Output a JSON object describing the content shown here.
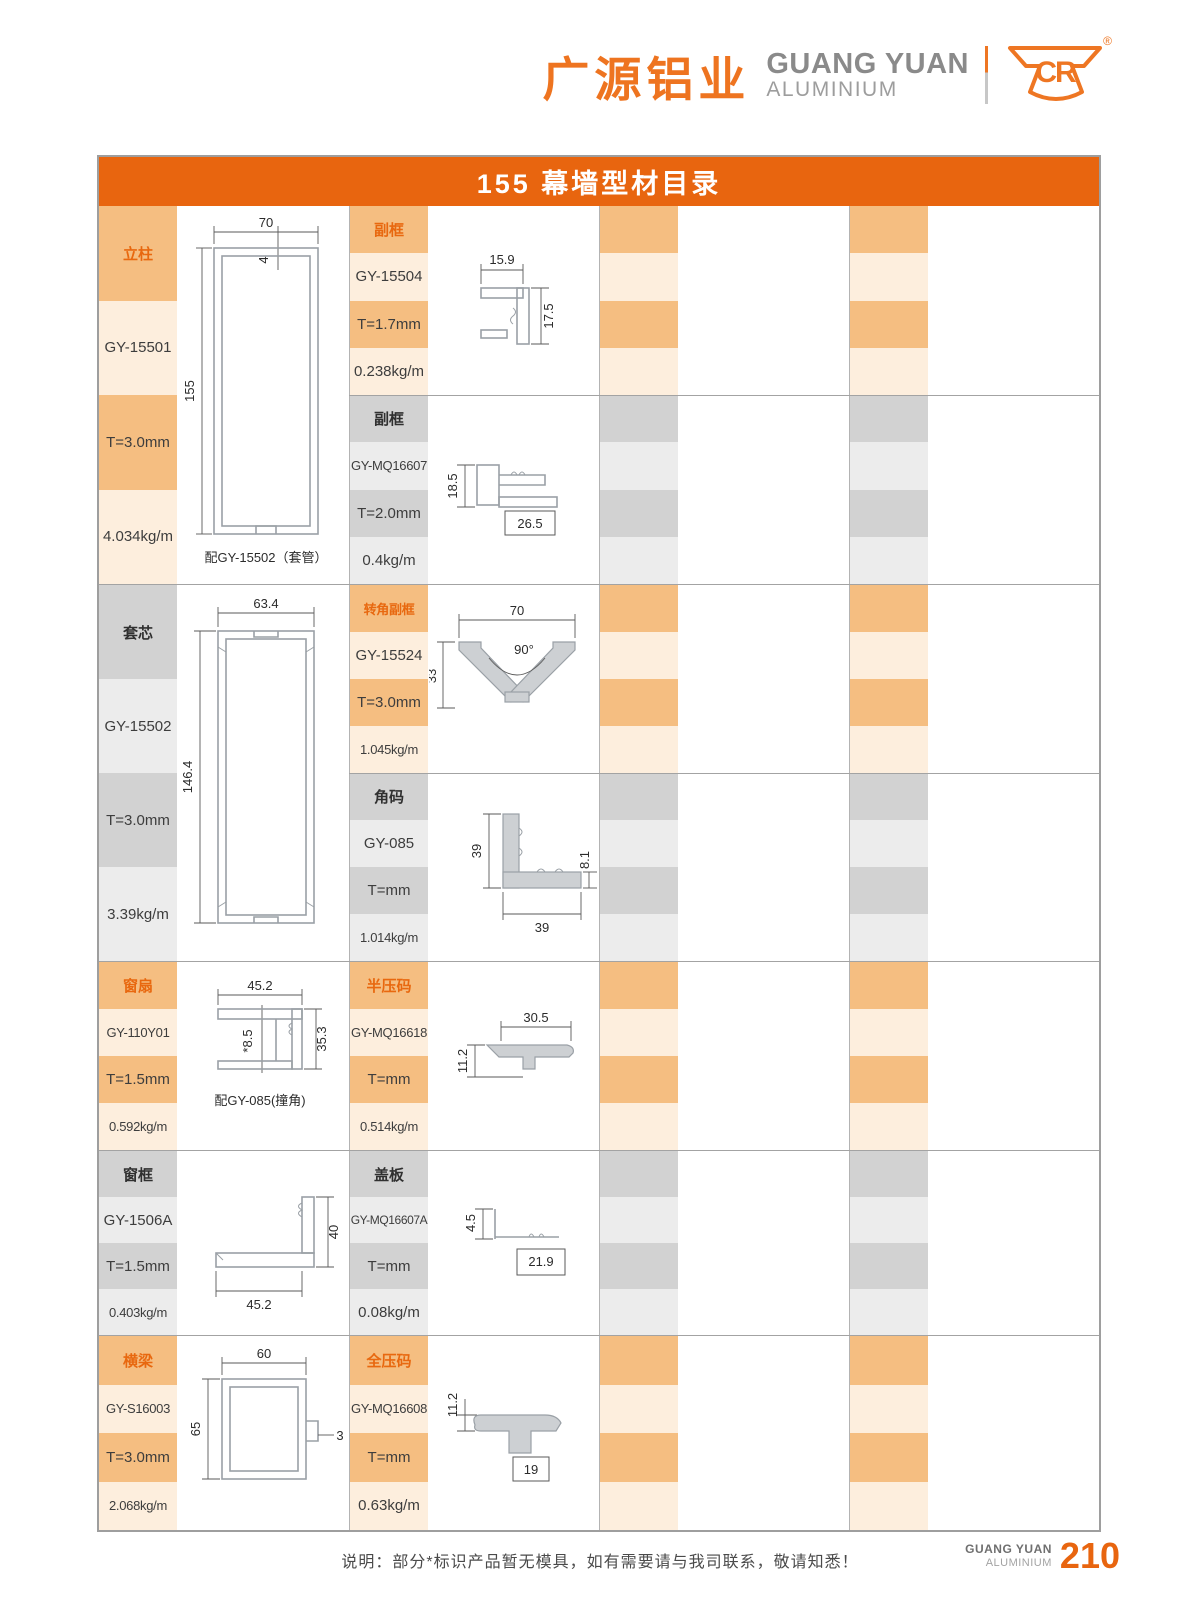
{
  "header": {
    "brand_cn": "广源铝业",
    "brand_en": "GUANG YUAN",
    "brand_sub": "ALUMINIUM",
    "logo_text": "CR",
    "reg_mark": "®"
  },
  "title_bar": {
    "text": "155 幕墙型材目录"
  },
  "bands": [
    {
      "left": {
        "name": "立柱",
        "code": "GY-15501",
        "thickness": "T=3.0mm",
        "weight": "4.034kg/m",
        "caption": "配GY-15502（套管）",
        "dims": {
          "width": "70",
          "wall": "4",
          "height": "155"
        }
      },
      "mid_top": {
        "name": "副框",
        "code": "GY-15504",
        "thickness": "T=1.7mm",
        "weight": "0.238kg/m",
        "dims": {
          "width": "15.9",
          "height": "17.5"
        }
      },
      "mid_bottom": {
        "name": "副框",
        "code": "GY-MQ16607",
        "thickness": "T=2.0mm",
        "weight": "0.4kg/m",
        "dims": {
          "height": "18.5",
          "width": "26.5"
        }
      }
    },
    {
      "left": {
        "name": "套芯",
        "code": "GY-15502",
        "thickness": "T=3.0mm",
        "weight": "3.39kg/m",
        "dims": {
          "width": "63.4",
          "height": "146.4"
        }
      },
      "mid_top": {
        "name": "转角副框",
        "code": "GY-15524",
        "thickness": "T=3.0mm",
        "weight": "1.045kg/m",
        "dims": {
          "width": "70",
          "angle": "90°",
          "height": "33"
        }
      },
      "mid_bottom": {
        "name": "角码",
        "code": "GY-085",
        "thickness": "T=mm",
        "weight": "1.014kg/m",
        "dims": {
          "height": "39",
          "width": "39",
          "depth": "8.1"
        }
      }
    },
    {
      "left": {
        "name": "窗扇",
        "code": "GY-110Y01",
        "thickness": "T=1.5mm",
        "weight": "0.592kg/m",
        "caption": "配GY-085(撞角)",
        "dims": {
          "width": "45.2",
          "inner": "*8.5",
          "height": "35.3"
        }
      },
      "mid": {
        "name": "半压码",
        "code": "GY-MQ16618",
        "thickness": "T=mm",
        "weight": "0.514kg/m",
        "dims": {
          "width": "30.5",
          "height": "11.2"
        }
      }
    },
    {
      "left": {
        "name": "窗框",
        "code": "GY-1506A",
        "thickness": "T=1.5mm",
        "weight": "0.403kg/m",
        "dims": {
          "height": "40",
          "width": "45.2"
        }
      },
      "mid": {
        "name": "盖板",
        "code": "GY-MQ16607A",
        "thickness": "T=mm",
        "weight": "0.08kg/m",
        "dims": {
          "height": "4.5",
          "width": "21.9"
        }
      }
    },
    {
      "left": {
        "name": "横梁",
        "code": "GY-S16003",
        "thickness": "T=3.0mm",
        "weight": "2.068kg/m",
        "dims": {
          "width": "60",
          "height": "65",
          "tab": "3"
        }
      },
      "mid": {
        "name": "全压码",
        "code": "GY-MQ16608",
        "thickness": "T=mm",
        "weight": "0.63kg/m",
        "dims": {
          "height": "11.2",
          "width": "19"
        }
      }
    }
  ],
  "footer": {
    "note": "说明：部分*标识产品暂无模具，如有需要请与我司联系，敬请知悉！",
    "brand_en": "GUANG YUAN",
    "brand_sub": "ALUMINIUM",
    "page": "210"
  },
  "colors": {
    "accent_orange": "#e8650f",
    "stripe_orange": "#f5be81",
    "stripe_orange_light": "#fdeedd",
    "stripe_gray": "#d2d2d2",
    "stripe_gray_light": "#ececec"
  }
}
